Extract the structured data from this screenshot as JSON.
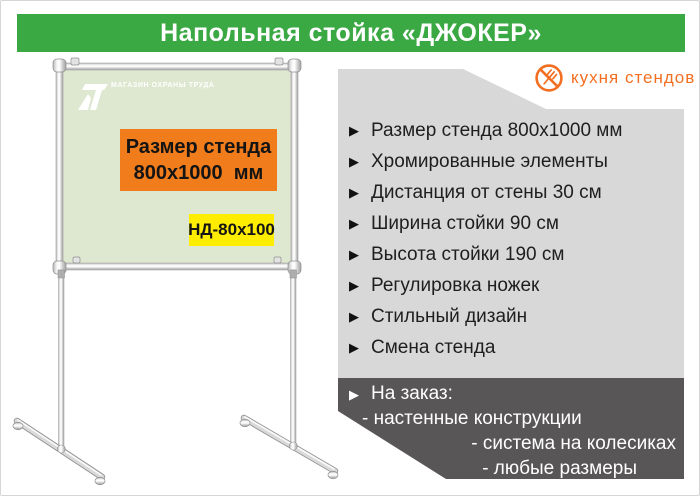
{
  "header": {
    "title": "Напольная стойка «ДЖОКЕР»",
    "bg_color": "#3aa843",
    "text_color": "#ffffff"
  },
  "brand": {
    "name": "кухня стендов",
    "icon": "crossed-fork-icon",
    "color": "#f26f21"
  },
  "stand": {
    "board": {
      "logo_text": "МАГАЗИН ОХРАНЫ ТРУДА",
      "size_line1": "Размер стенда",
      "size_line2": "800х1000  мм",
      "model_code": "НД-80х100",
      "face_color": "#dee8d1",
      "size_bg_color": "#f07c1c",
      "model_bg_color": "#ffed00",
      "frame_color": "#c9c9c9"
    }
  },
  "features": {
    "marker": "▶",
    "bg_color": "#d8d8d8",
    "items": [
      "Размер стенда 800х1000 мм",
      "Хромированные элементы",
      "Дистанция от стены 30 см",
      "Ширина стойки 90 см",
      "Высота стойки 190 см",
      "Регулировка ножек",
      "Стильный дизайн",
      "Смена стенда"
    ]
  },
  "custom_order": {
    "bg_color": "#585656",
    "title": "На заказ:",
    "items": [
      "- настенные конструкции",
      "- система на колесиках",
      "- любые размеры"
    ]
  }
}
